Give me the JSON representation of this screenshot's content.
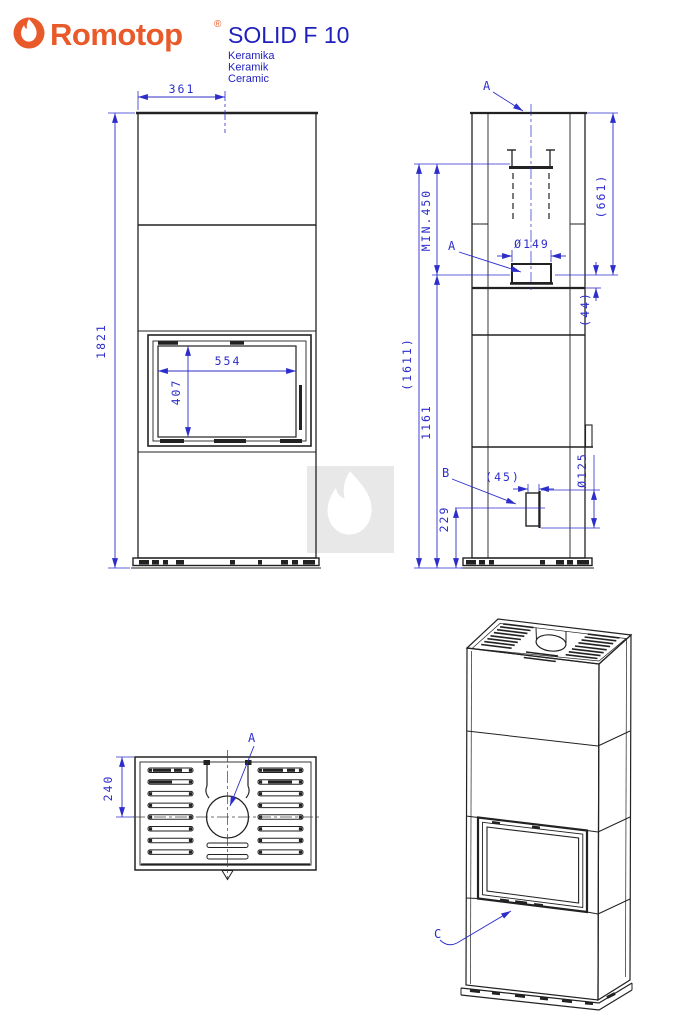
{
  "header": {
    "brand": "Romotop",
    "registered_mark": "®",
    "model": "SOLID F 10",
    "subtitles": [
      "Keramika",
      "Keramik",
      "Ceramic"
    ]
  },
  "colors": {
    "brand_orange": "#e95a2b",
    "dimension_blue": "#2d2dcb",
    "line_black": "#222222",
    "title_blue": "#1f1fbe",
    "watermark_gray": "#e8e8e8"
  },
  "front_view": {
    "dim_width_to_flue_center": "361",
    "dim_total_height": "1821",
    "dim_glass_width": "554",
    "dim_glass_height": "407"
  },
  "side_view": {
    "label_top_outlet": "A",
    "label_rear_outlet": "A",
    "label_air_inlet": "B",
    "dim_min_clearance": "MIN.450",
    "dim_top_outlet_height": "(1611)",
    "dim_rear_outlet_height": "1161",
    "dim_rear_outlet_from_top": "(661)",
    "dim_flue_diameter": "Ø149",
    "dim_outlet_to_joint": "(44)",
    "dim_inlet_offset": "(45)",
    "dim_inlet_diameter": "Ø125",
    "dim_inlet_height": "229"
  },
  "top_view": {
    "label_flue_outlet": "A",
    "dim_flue_center_depth": "240"
  },
  "iso_view": {
    "label_door": "C"
  }
}
